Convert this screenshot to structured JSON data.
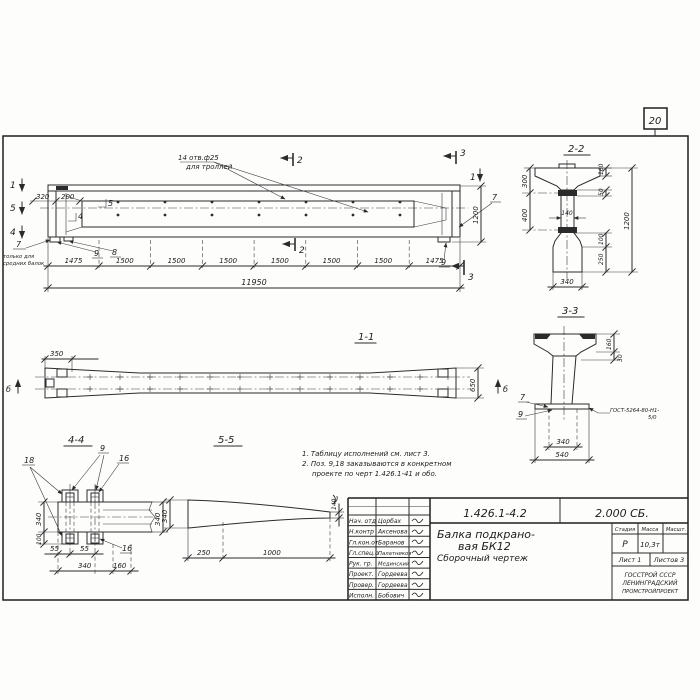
{
  "page_number": "20",
  "main_view": {
    "callout": {
      "line1": "14 отв.ф25",
      "line2": "для троллей"
    },
    "section_marks": {
      "m1_left": "1",
      "m5_left": "5",
      "m4_left": "4",
      "m5_inner": "5",
      "m4_inner": "4",
      "m2_top": "2",
      "m2_bottom": "2",
      "m3_top": "3",
      "m3_bottom": "3",
      "m1_right": "1"
    },
    "positions": {
      "p7_left": "7",
      "p9_left": "9",
      "p8": "8",
      "p7_right": "7",
      "p9_right": "9"
    },
    "left_note": {
      "line1": "только для",
      "line2": "средних балок"
    },
    "dims": {
      "d320": "320",
      "d200": "200",
      "d1200": "1200",
      "total": "11950",
      "segments": [
        "1475",
        "1500",
        "1500",
        "1500",
        "1500",
        "1500",
        "1500",
        "1475"
      ]
    }
  },
  "section_1_1": {
    "title": "1-1",
    "view_mark": "б",
    "dims": {
      "d350": "350",
      "d650": "650"
    }
  },
  "section_2_2": {
    "title": "2-2",
    "dims": {
      "d300": "300",
      "d400": "400",
      "d160": "160",
      "d50": "50",
      "d140": "140",
      "d1200": "1200",
      "d100": "100",
      "d250": "250",
      "d340": "340"
    }
  },
  "section_3_3": {
    "title": "3-3",
    "dims": {
      "d160": "160",
      "d30": "30",
      "d340": "340",
      "d540": "540"
    },
    "positions": {
      "p7": "7",
      "p9": "9"
    },
    "weld": {
      "line1": "ГОСТ-5264-80-Н1-",
      "line2": "5/0"
    }
  },
  "section_4_4": {
    "title": "4-4",
    "positions": {
      "p9": "9",
      "p18": "18",
      "p16_top": "16",
      "p16_bottom": "16"
    },
    "dims": {
      "d340_left": "340",
      "d100": "100",
      "d340_right": "340",
      "d55_a": "55",
      "d55_b": "55",
      "d340_bottom": "340",
      "d160": "160"
    }
  },
  "section_5_5": {
    "title": "5-5",
    "dims": {
      "d340": "340",
      "d250": "250",
      "d1000": "1000",
      "d140": "140"
    }
  },
  "notes": {
    "line1": "1. Таблицу исполнений см. лист 3.",
    "line2": "2. Поз. 9,18 заказываются в конкретном",
    "line3": "проекте по черт 1.426.1-41 и обо."
  },
  "title_block": {
    "doc_number": "1.426.1-4.2",
    "doc_code": "2.000 СБ.",
    "title": {
      "line1": "Балка подкрано-",
      "line2": "вая БК12",
      "line3": "Сборочный чертеж"
    },
    "columns": {
      "stage": "Стадия",
      "mass": "Масса",
      "scale": "Масшт."
    },
    "values": {
      "stage": "Р",
      "mass": "10,3т"
    },
    "sheet": "Лист 1",
    "sheets": "Листов 3",
    "organization": {
      "line1": "ГОССТРОЙ СССР",
      "line2": "ЛЕНИНГРАДСКИЙ",
      "line3": "ПРОМСТРОЙПРОЕКТ"
    },
    "signature_rows": [
      {
        "role": "Нач. отд",
        "name": "Цорбах"
      },
      {
        "role": "Н.контр",
        "name": "Аксенова"
      },
      {
        "role": "Гл.кон.от",
        "name": "Баранов"
      },
      {
        "role": "Гл.спец.о",
        "name": "Палатников"
      },
      {
        "role": "Рук. гр.",
        "name": "Мединский"
      },
      {
        "role": "Проект.",
        "name": "Гордеева"
      },
      {
        "role": "Провер.",
        "name": "Гордеева"
      },
      {
        "role": "Исполн.",
        "name": "Бобович"
      }
    ]
  }
}
